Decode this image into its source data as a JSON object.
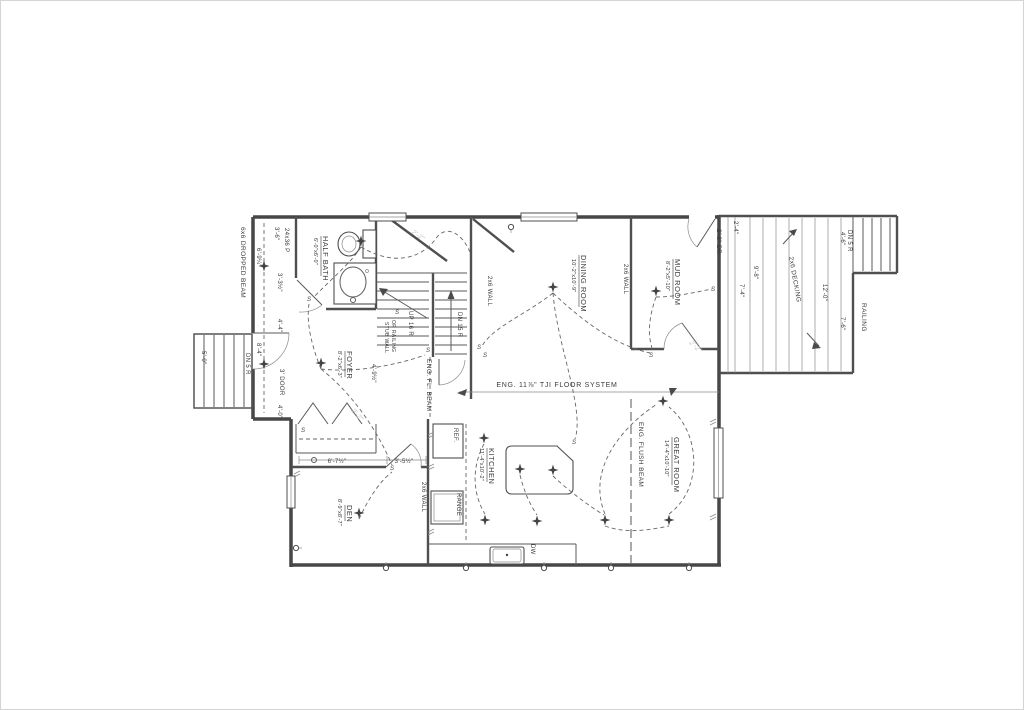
{
  "plan": {
    "rooms": {
      "half_bath": {
        "name": "HALF BATH",
        "dims": "6'-0\"x6'-0\""
      },
      "dining_room": {
        "name": "DINING ROOM",
        "dims": "10'-2\"x10'-9\""
      },
      "mud_room": {
        "name": "MUD ROOM",
        "dims": "8'-2\"x5'-10\""
      },
      "foyer": {
        "name": "FOYER",
        "dims": "8'-2\"x6'-3\""
      },
      "kitchen": {
        "name": "KITCHEN",
        "dims": "11'-4\"x10'-2\""
      },
      "great_room": {
        "name": "GREAT ROOM",
        "dims": "14'-4\"x10'-10\""
      },
      "den": {
        "name": "DEN",
        "dims": "8'-9\"x8'-7\""
      }
    },
    "structure": {
      "tji_floor": "ENG. 11⅞\" TJI FLOOR SYSTEM",
      "flush_beam": "ENG. FLUSH BEAM",
      "fl_beam": "ENG. FL. BEAM",
      "dropped_beam": "6x6 DROPPED BEAM",
      "wall_2x6_dining_left": "2x6 WALL",
      "wall_2x6_dining_right": "2x6 WALL",
      "wall_2x6_den": "2x6 WALL",
      "stub_wall_line1": "STUB WALL",
      "stub_wall_line2": "OR RAILING"
    },
    "stairs": {
      "up_main": "UP 16 R",
      "down_basement": "DN 15 R",
      "porch_down": "DN 5 R",
      "deck_down": "DN 5 R"
    },
    "deck": {
      "material": "2x6 DECKING",
      "railing": "RAILING"
    },
    "appliances": {
      "ref": "REF.",
      "range": "RANGE",
      "dw": "DW"
    },
    "doors": {
      "front": "3' DOOR",
      "mud_deck": "2'-8\" DR",
      "window_note": "24x36 P"
    },
    "dimensions": {
      "hall_top": "3'-6\"",
      "hall_a": "6'-9¼\"",
      "hall_b": "3'-3½\"",
      "hall_c": "4'-4\"",
      "hall_d": "8'-4\"",
      "hall_e": "4'-0\"",
      "porch_width": "5'-0\"",
      "foyer_w": "4'-9½\"",
      "closet_a": "6'-7½\"",
      "closet_b": "3'-5½\"",
      "deck_a": "2'-4\"",
      "deck_b": "7'-4\"",
      "deck_c": "9'-8\"",
      "deck_d": "12'-0\"",
      "deck_stairs": "4'-6\"",
      "deck_rail": "7'-6\""
    },
    "symbols": {
      "switch": "S"
    },
    "pencil_note": "2'-2\""
  }
}
